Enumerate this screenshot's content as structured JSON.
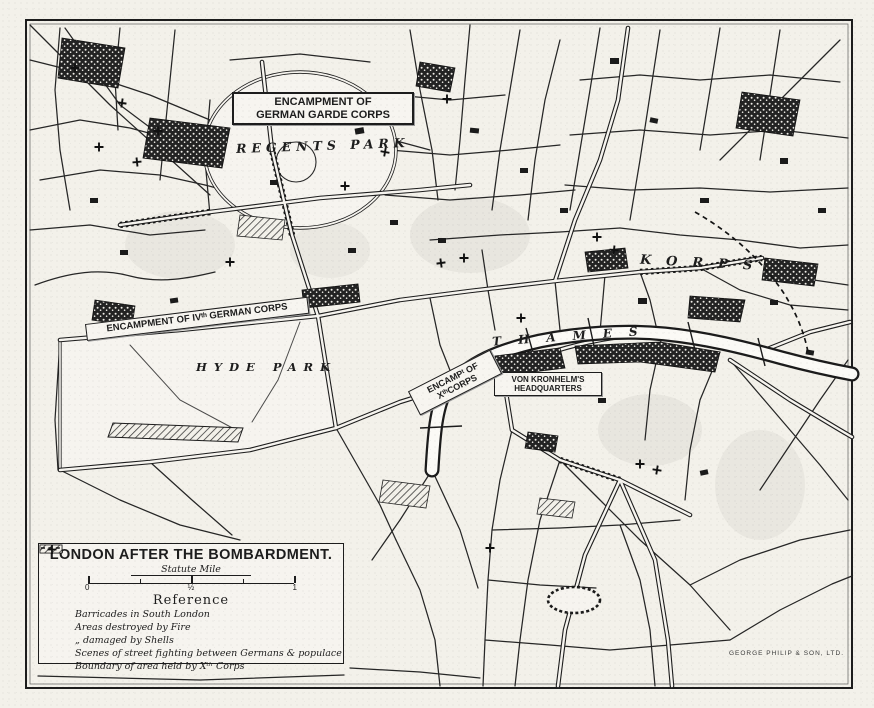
{
  "map": {
    "title": "LONDON AFTER THE BOMBARDMENT.",
    "credit": "GEORGE PHILIP & SON, LTD.",
    "scale": {
      "label": "Statute Mile",
      "ticks": [
        "0",
        "½",
        "1"
      ]
    },
    "reference": {
      "heading": "Reference",
      "items": [
        {
          "symbol": "barricade-symbol",
          "label": "Barricades in South London"
        },
        {
          "symbol": "fire-symbol",
          "label": "Areas destroyed by Fire"
        },
        {
          "symbol": "shell-symbol",
          "label": "„    damaged by Shells"
        },
        {
          "symbol": "cross-symbol",
          "label": "Scenes of street fighting between Germans & populace"
        },
        {
          "symbol": "boundary-symbol",
          "label": "Boundary of area held by Xᵗʰ Corps"
        }
      ]
    },
    "labels": {
      "garde_line1": "ENCAMPMENT OF",
      "garde_line2": "GERMAN GARDE CORPS",
      "regents_park": "REGENTS PARK",
      "iv_corps": "ENCAMPMENT OF IVᵗʰ GERMAN CORPS",
      "hyde_park": "HYDE PARK",
      "hq_line1": "VON KRONHELM'S",
      "hq_line2": "HEADQUARTERS",
      "x_line1": "ENCAMPᵗ OF",
      "x_line2": "XᵗʰCORPS",
      "thames": "THAMES",
      "korps": "KORPS"
    },
    "colors": {
      "ink": "#1d1d1d",
      "paper": "#f3f1ea"
    }
  }
}
